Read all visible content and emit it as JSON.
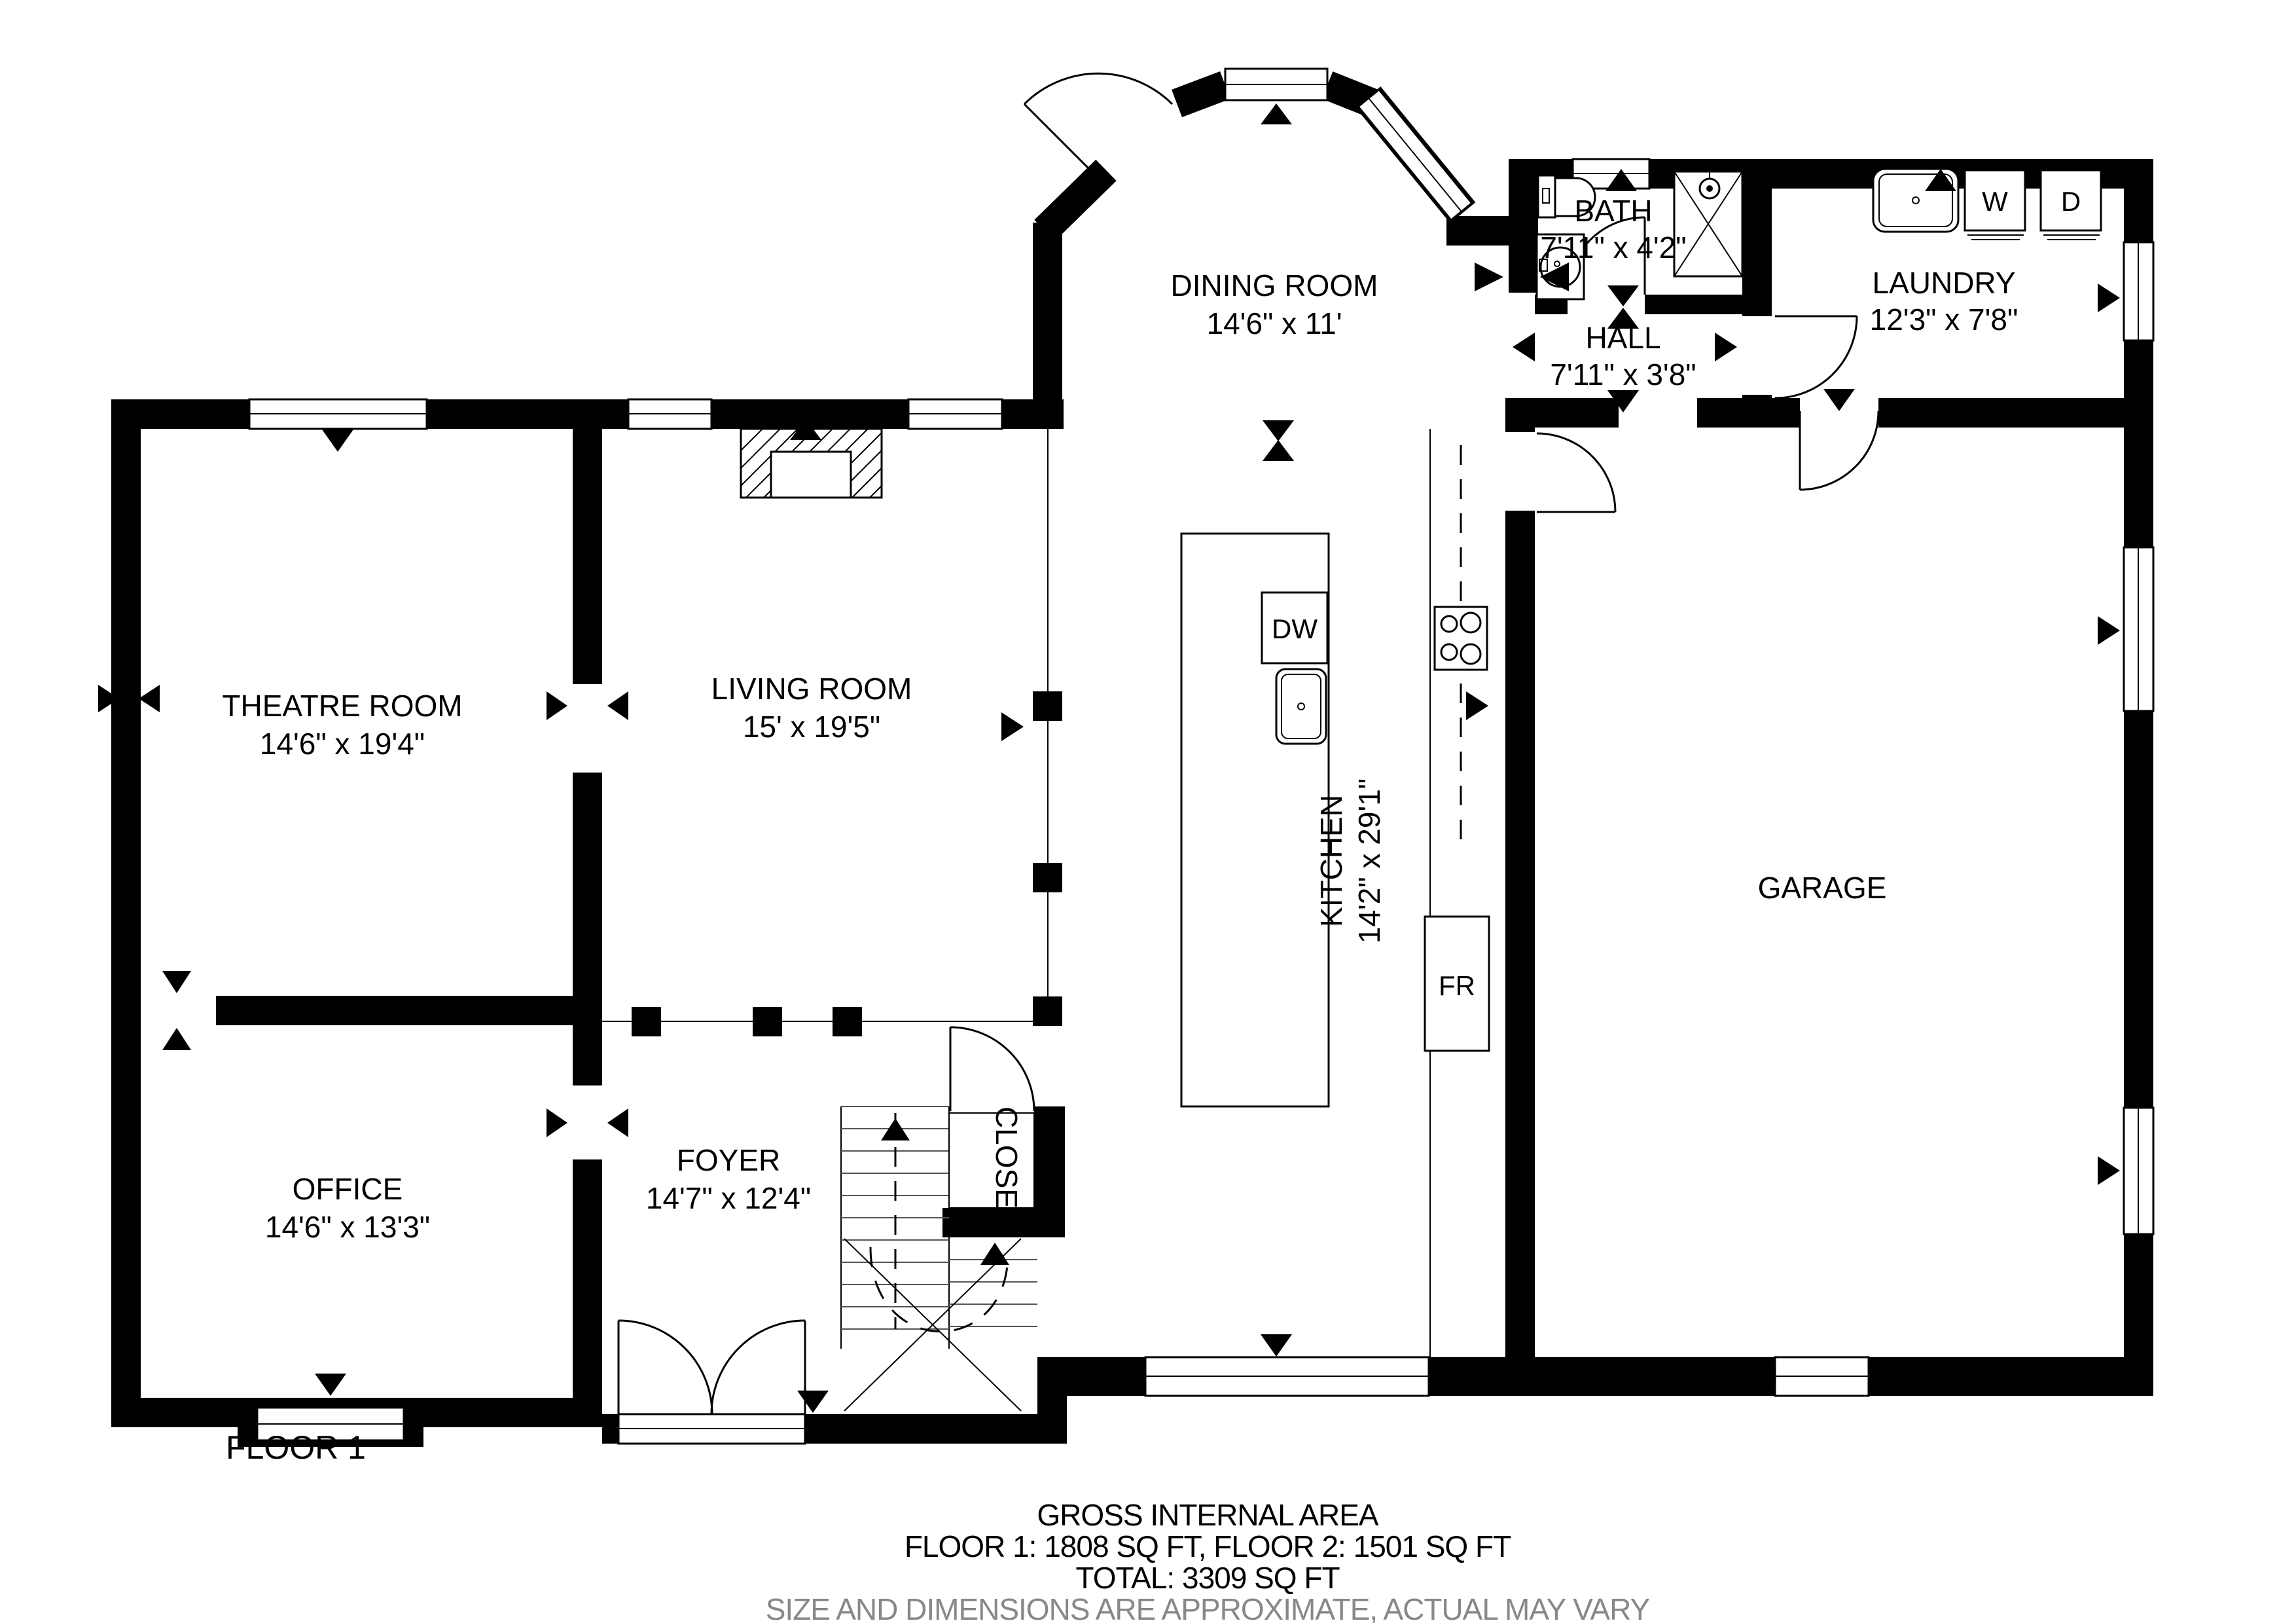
{
  "floorplan": {
    "floor_label": "FLOOR 1",
    "rooms": {
      "dining": {
        "name": "DINING ROOM",
        "dims": "14'6\" x 11'"
      },
      "bath": {
        "name": "BATH",
        "dims": "7'11\" x 4'2\""
      },
      "hall": {
        "name": "HALL",
        "dims": "7'11\" x 3'8\""
      },
      "laundry": {
        "name": "LAUNDRY",
        "dims": "12'3\" x 7'8\""
      },
      "theatre": {
        "name": "THEATRE ROOM",
        "dims": "14'6\" x 19'4\""
      },
      "living": {
        "name": "LIVING ROOM",
        "dims": "15' x 19'5\""
      },
      "kitchen": {
        "name": "KITCHEN",
        "dims": "14'2\" x 29'1\""
      },
      "garage": {
        "name": "GARAGE"
      },
      "office": {
        "name": "OFFICE",
        "dims": "14'6\" x 13'3\""
      },
      "foyer": {
        "name": "FOYER",
        "dims": "14'7\" x 12'4\""
      },
      "closet": {
        "name": "CLOSET"
      }
    },
    "appliances": {
      "dishwasher": "DW",
      "fridge": "FR",
      "washer": "W",
      "dryer": "D"
    },
    "footer": {
      "title": "GROSS INTERNAL AREA",
      "line1": "FLOOR 1: 1808 SQ FT, FLOOR 2: 1501 SQ FT",
      "line2": "TOTAL: 3309 SQ FT",
      "disclaimer": "SIZE AND DIMENSIONS ARE APPROXIMATE, ACTUAL MAY VARY"
    },
    "colors": {
      "wall": "#000000",
      "line": "#000000",
      "disclaimer_text": "#888888",
      "background": "#ffffff"
    }
  }
}
